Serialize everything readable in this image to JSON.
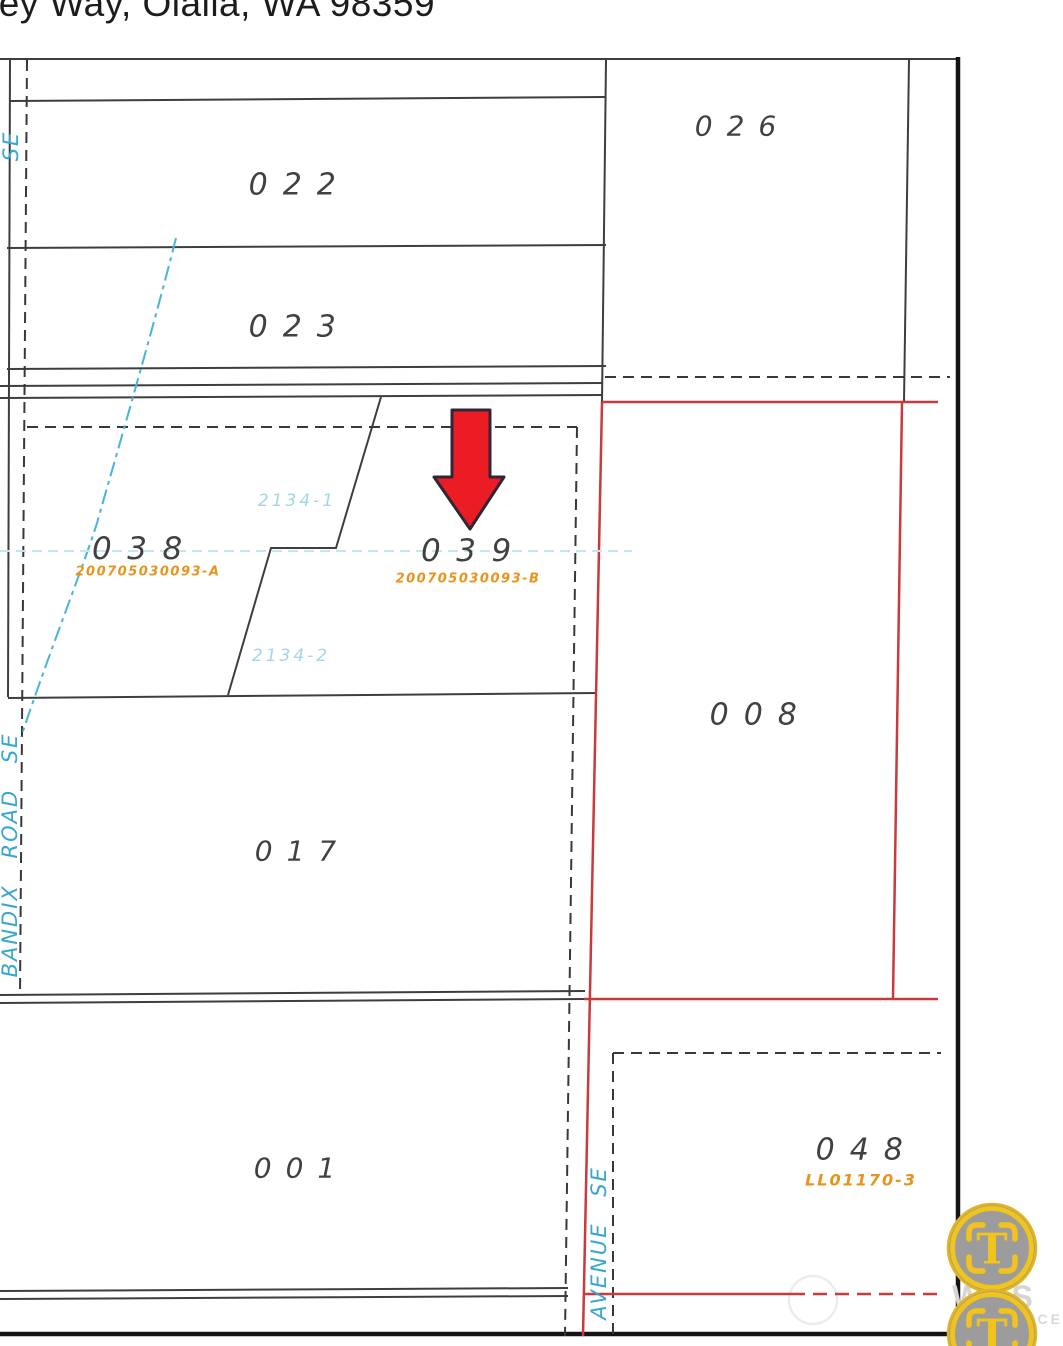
{
  "header": {
    "address_partial": "ley Way, Olalla, WA 98359"
  },
  "map": {
    "lots": [
      {
        "number": "022"
      },
      {
        "number": "023"
      },
      {
        "number": "026"
      },
      {
        "number": "038",
        "parcel_id": "200705030093-A"
      },
      {
        "number": "039",
        "parcel_id": "200705030093-B"
      },
      {
        "number": "008"
      },
      {
        "number": "017"
      },
      {
        "number": "001"
      },
      {
        "number": "048",
        "parcel_id": "LL01170-3"
      }
    ],
    "subject_lot": "039",
    "roads": [
      {
        "label": "SE"
      },
      {
        "label": "BANDIX ROAD SE"
      },
      {
        "label": "AVENUE SE"
      }
    ],
    "stream_labels": [
      {
        "label": "2134-1"
      },
      {
        "label": "2134-2"
      }
    ],
    "colors": {
      "parcel_line_red": "#c93a3c",
      "boundary_dash": "#383838",
      "lot_text": "#414141",
      "parcel_id_text": "#e8941c",
      "road_text": "#38a6ce",
      "stream_line": "#47b5d8",
      "arrow_fill": "#ec1c24",
      "badge_gold": "#f0c31d",
      "badge_gray": "#9c9c9c"
    }
  },
  "marker": {
    "type": "down-arrow",
    "points_to": "039"
  },
  "watermark": {
    "badge_letter": "T",
    "text_line1": "WES",
    "text_line2": "G SERVICE"
  }
}
